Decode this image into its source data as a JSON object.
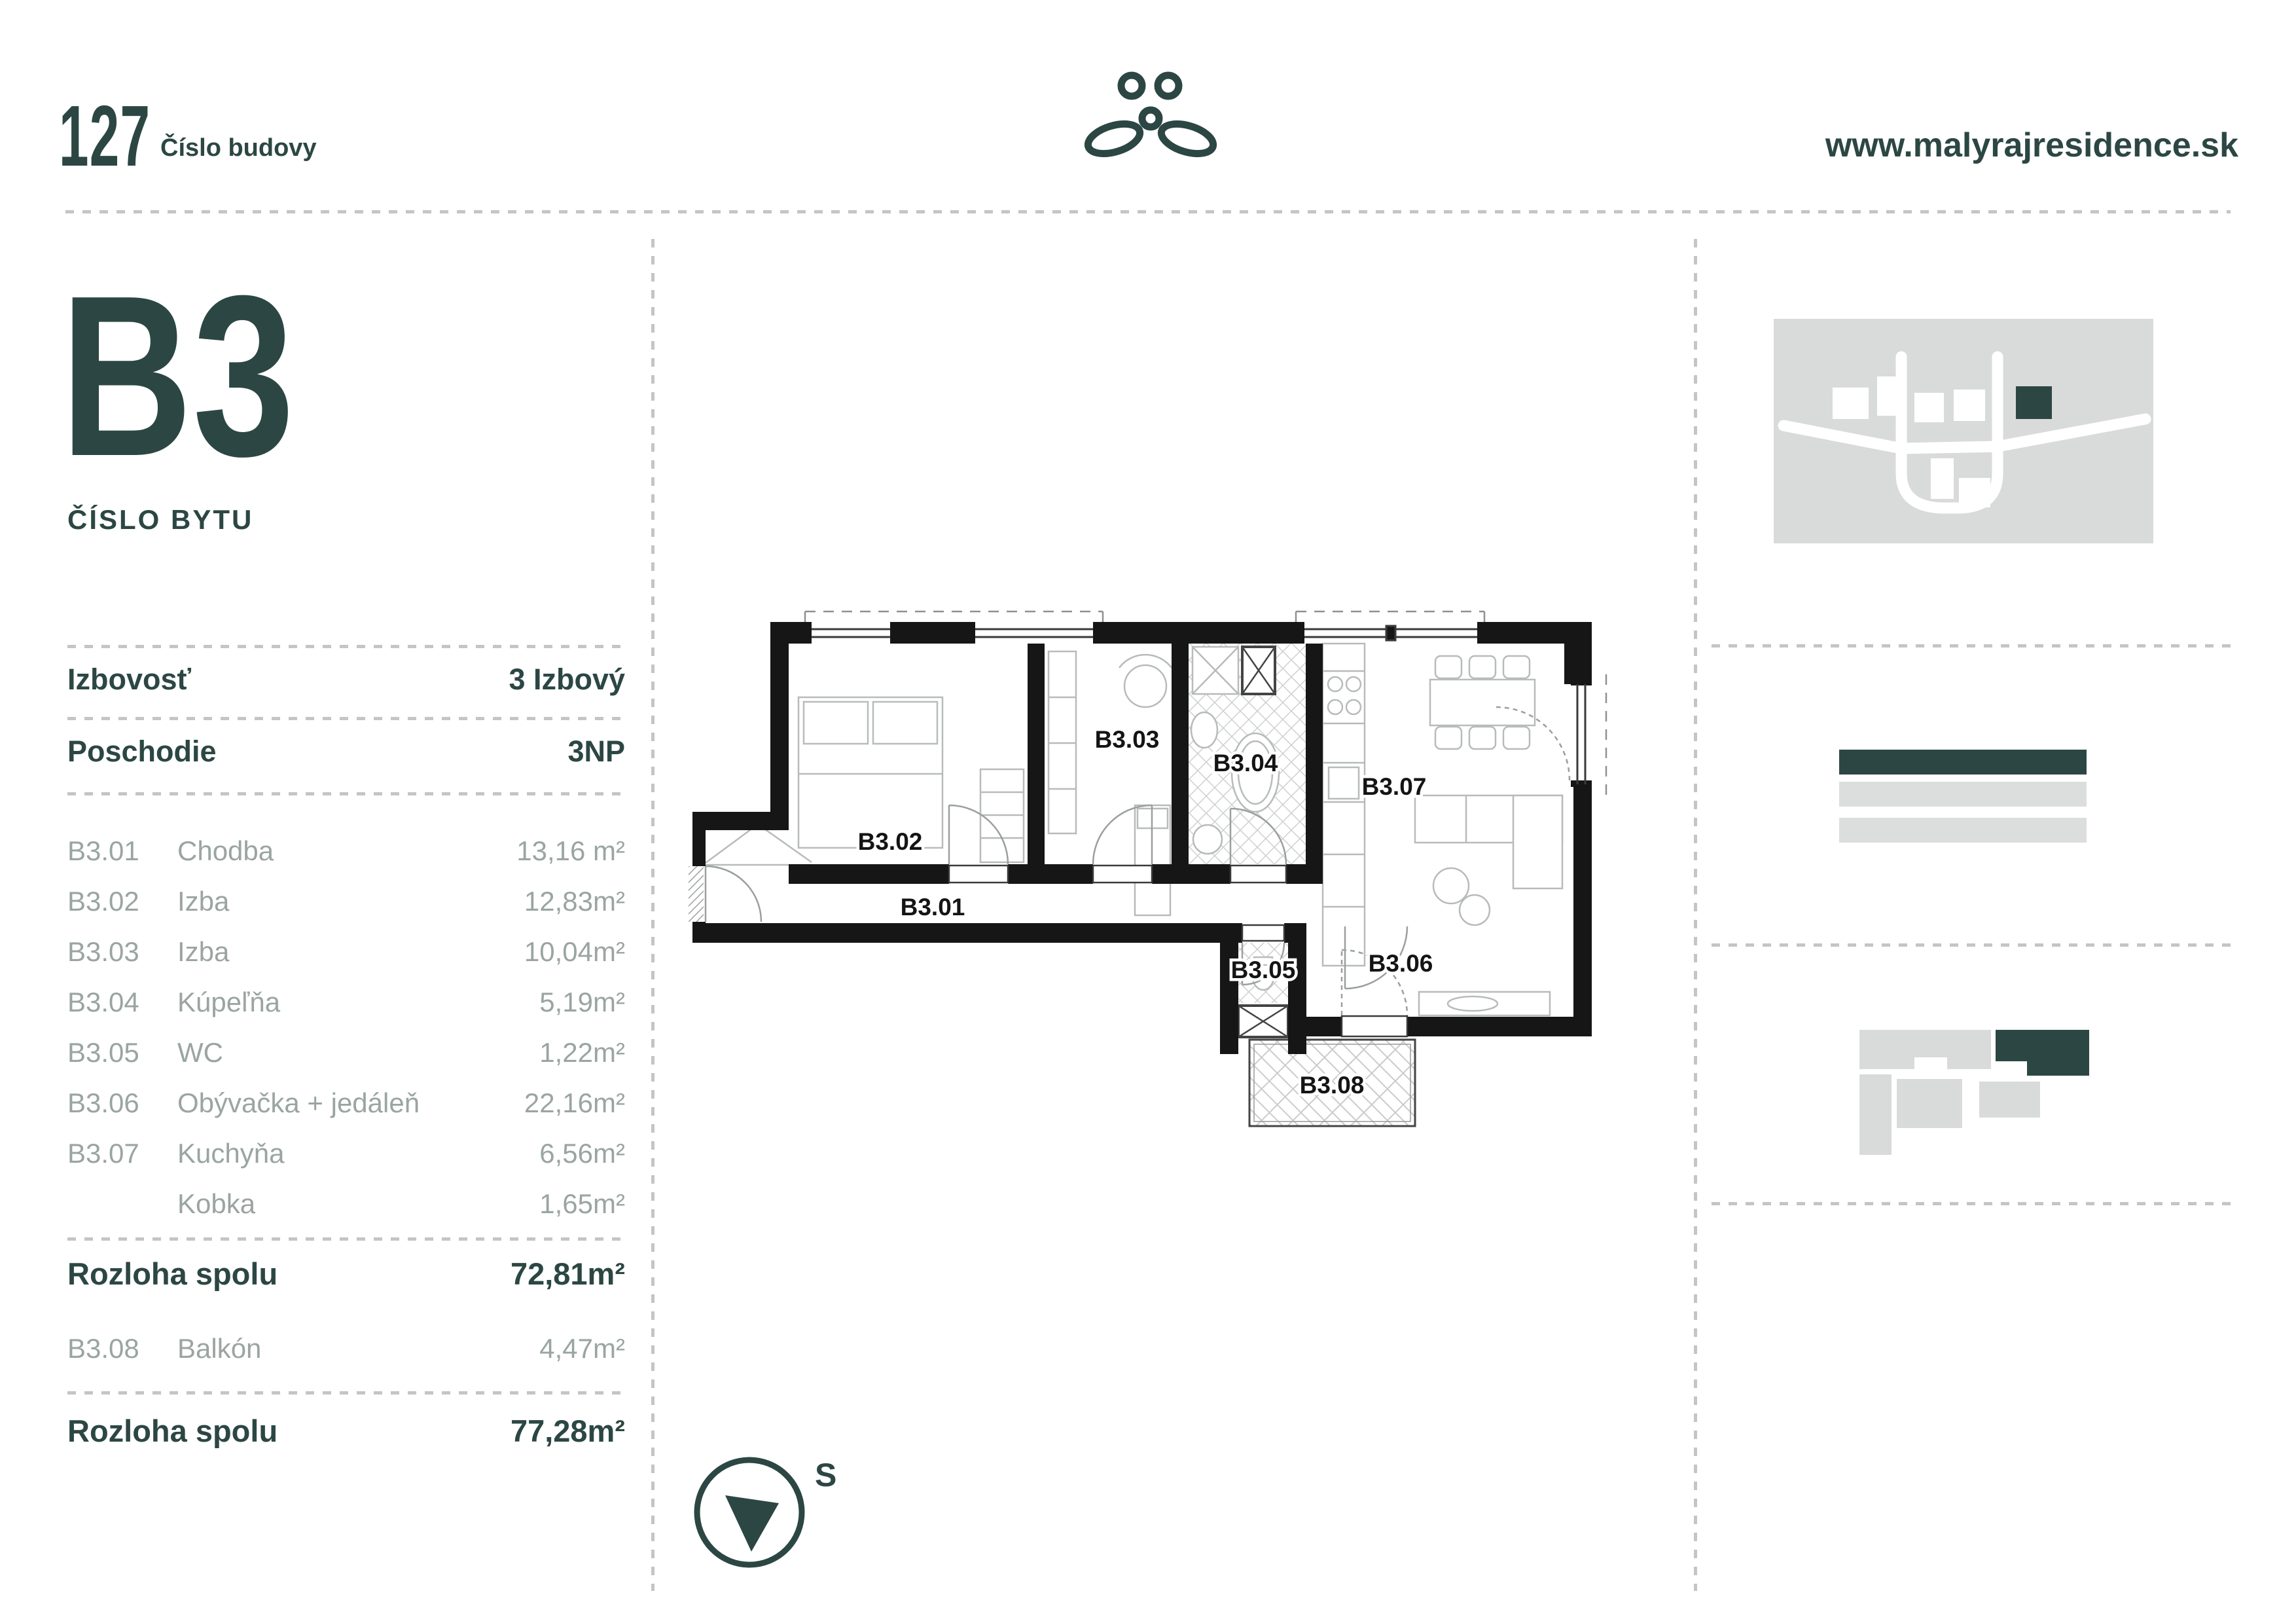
{
  "page": {
    "accent_color": "#2c4743",
    "muted_text_color": "#9aa5a1",
    "panel_gray": "#d9dbda"
  },
  "header": {
    "building_number": "127",
    "building_number_label": "Číslo budovy",
    "website": "www.malyrajresidence.sk",
    "logo": "maly-raj-plant-logo"
  },
  "unit": {
    "code": "B3",
    "code_label": "ČÍSLO BYTU"
  },
  "specs": {
    "rows": [
      {
        "label": "Izbovosť",
        "value": "3 Izbový"
      },
      {
        "label": "Poschodie",
        "value": "3NP"
      }
    ]
  },
  "rooms": [
    {
      "code": "B3.01",
      "name": "Chodba",
      "area": "13,16 m²"
    },
    {
      "code": "B3.02",
      "name": "Izba",
      "area": "12,83m²"
    },
    {
      "code": "B3.03",
      "name": "Izba",
      "area": "10,04m²"
    },
    {
      "code": "B3.04",
      "name": "Kúpeľňa",
      "area": "5,19m²"
    },
    {
      "code": "B3.05",
      "name": "WC",
      "area": "1,22m²"
    },
    {
      "code": "B3.06",
      "name": "Obývačka + jedáleň",
      "area": "22,16m²"
    },
    {
      "code": "B3.07",
      "name": "Kuchyňa",
      "area": "6,56m²"
    },
    {
      "code": "",
      "name": "Kobka",
      "area": "1,65m²"
    }
  ],
  "totals": {
    "interior": {
      "label": "Rozloha spolu",
      "value": "72,81m²"
    },
    "balcony_row": {
      "code": "B3.08",
      "name": "Balkón",
      "area": "4,47m²"
    },
    "total": {
      "label": "Rozloha spolu",
      "value": "77,28m²"
    }
  },
  "plan": {
    "labels": {
      "r01": "B3.01",
      "r02": "B3.02",
      "r03": "B3.03",
      "r04": "B3.04",
      "r05": "B3.05",
      "r06": "B3.06",
      "r07": "B3.07",
      "r08": "B3.08"
    },
    "compass_label": "S"
  }
}
